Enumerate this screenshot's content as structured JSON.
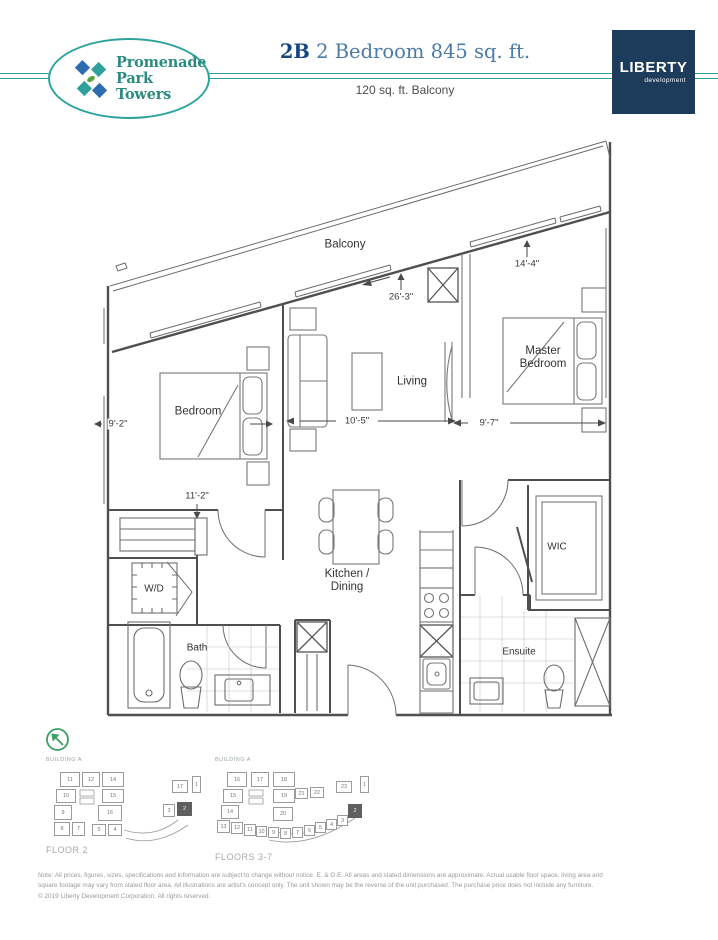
{
  "header": {
    "logo_line1": "Promenade",
    "logo_line2": "Park Towers",
    "unit_code": "2B",
    "title": " 2 Bedroom 845 sq. ft.",
    "subtitle": "120 sq. ft. Balcony",
    "developer_name": "LIBERTY",
    "developer_sub": "development"
  },
  "floorplan": {
    "labels": {
      "balcony": "Balcony",
      "bedroom": "Bedroom",
      "living": "Living",
      "master_line1": "Master",
      "master_line2": "Bedroom",
      "kitchen_line1": "Kitchen /",
      "kitchen_line2": "Dining",
      "wd": "W/D",
      "bath": "Bath",
      "wic": "WIC",
      "ensuite": "Ensuite"
    },
    "dimensions": {
      "balcony_run": "26'-3\"",
      "master_top": "14'-4\"",
      "bedroom_width": "9'-2\"",
      "living_width": "10'-5\"",
      "master_width": "9'-7\"",
      "bedroom_length": "11'-2\""
    }
  },
  "keyplans": {
    "floor2": {
      "building": "BUILDING A",
      "label": "FLOOR 2",
      "highlight": "2",
      "units": [
        {
          "n": "11",
          "x": 14,
          "y": 6,
          "w": 20,
          "h": 15
        },
        {
          "n": "12",
          "x": 36,
          "y": 6,
          "w": 18,
          "h": 15
        },
        {
          "n": "14",
          "x": 56,
          "y": 6,
          "w": 22,
          "h": 15
        },
        {
          "n": "10",
          "x": 10,
          "y": 23,
          "w": 20,
          "h": 14
        },
        {
          "n": "15",
          "x": 56,
          "y": 23,
          "w": 22,
          "h": 14
        },
        {
          "n": "9",
          "x": 8,
          "y": 39,
          "w": 18,
          "h": 15
        },
        {
          "n": "16",
          "x": 52,
          "y": 39,
          "w": 24,
          "h": 16
        },
        {
          "n": "8",
          "x": 8,
          "y": 56,
          "w": 16,
          "h": 14
        },
        {
          "n": "7",
          "x": 26,
          "y": 56,
          "w": 13,
          "h": 14
        },
        {
          "n": "5",
          "x": 46,
          "y": 58,
          "w": 14,
          "h": 12
        },
        {
          "n": "4",
          "x": 62,
          "y": 58,
          "w": 14,
          "h": 12
        },
        {
          "n": "17",
          "x": 126,
          "y": 14,
          "w": 16,
          "h": 13
        },
        {
          "n": "1",
          "x": 146,
          "y": 10,
          "w": 9,
          "h": 17
        },
        {
          "n": "3",
          "x": 117,
          "y": 38,
          "w": 12,
          "h": 13
        },
        {
          "n": "2",
          "x": 131,
          "y": 36,
          "w": 15,
          "h": 14
        }
      ]
    },
    "floors37": {
      "building": "BUILDING A",
      "label": "FLOORS 3-7",
      "highlight": "2",
      "units": [
        {
          "n": "16",
          "x": 12,
          "y": 6,
          "w": 20,
          "h": 15
        },
        {
          "n": "17",
          "x": 36,
          "y": 6,
          "w": 18,
          "h": 15
        },
        {
          "n": "18",
          "x": 58,
          "y": 6,
          "w": 22,
          "h": 15
        },
        {
          "n": "15",
          "x": 8,
          "y": 23,
          "w": 20,
          "h": 14
        },
        {
          "n": "19",
          "x": 58,
          "y": 23,
          "w": 22,
          "h": 14
        },
        {
          "n": "14",
          "x": 6,
          "y": 39,
          "w": 18,
          "h": 14
        },
        {
          "n": "20",
          "x": 58,
          "y": 41,
          "w": 20,
          "h": 14
        },
        {
          "n": "13",
          "x": 2,
          "y": 54,
          "w": 13,
          "h": 13
        },
        {
          "n": "12",
          "x": 16,
          "y": 56,
          "w": 12,
          "h": 12
        },
        {
          "n": "11",
          "x": 29,
          "y": 58,
          "w": 12,
          "h": 12
        },
        {
          "n": "10",
          "x": 41,
          "y": 60,
          "w": 11,
          "h": 11
        },
        {
          "n": "9",
          "x": 53,
          "y": 61,
          "w": 11,
          "h": 11
        },
        {
          "n": "8",
          "x": 65,
          "y": 62,
          "w": 11,
          "h": 11
        },
        {
          "n": "7",
          "x": 77,
          "y": 61,
          "w": 11,
          "h": 11
        },
        {
          "n": "6",
          "x": 89,
          "y": 59,
          "w": 11,
          "h": 11
        },
        {
          "n": "5",
          "x": 100,
          "y": 56,
          "w": 11,
          "h": 11
        },
        {
          "n": "4",
          "x": 111,
          "y": 53,
          "w": 11,
          "h": 11
        },
        {
          "n": "3",
          "x": 122,
          "y": 49,
          "w": 11,
          "h": 11
        },
        {
          "n": "21",
          "x": 80,
          "y": 22,
          "w": 13,
          "h": 11
        },
        {
          "n": "22",
          "x": 95,
          "y": 21,
          "w": 14,
          "h": 11
        },
        {
          "n": "23",
          "x": 121,
          "y": 15,
          "w": 16,
          "h": 12
        },
        {
          "n": "2",
          "x": 133,
          "y": 38,
          "w": 14,
          "h": 14
        },
        {
          "n": "1",
          "x": 145,
          "y": 10,
          "w": 9,
          "h": 17
        }
      ]
    }
  },
  "footer": {
    "note_line1": "Note: All prices, figures, sizes, specifications and information are subject to change without notice. E. & O.E. All areas and stated dimensions are approximate. Actual usable floor space, living area and",
    "note_line2": "square footage may vary from stated floor area. All illustrations are artist's concept only. The unit shown may be the reverse of the unit purchased. The purchase price does not include any furniture.",
    "copyright": "© 2019 Liberty Development Corporation. All rights reserved."
  },
  "colors": {
    "accent_teal": "#2ea39e",
    "title_blue": "#4a7ba6",
    "unit_navy": "#16477c",
    "liberty_navy": "#1d3b5a",
    "compass_green": "#3c9f63",
    "logo_blue": "#2e6cb0",
    "logo_green": "#57a33e"
  }
}
